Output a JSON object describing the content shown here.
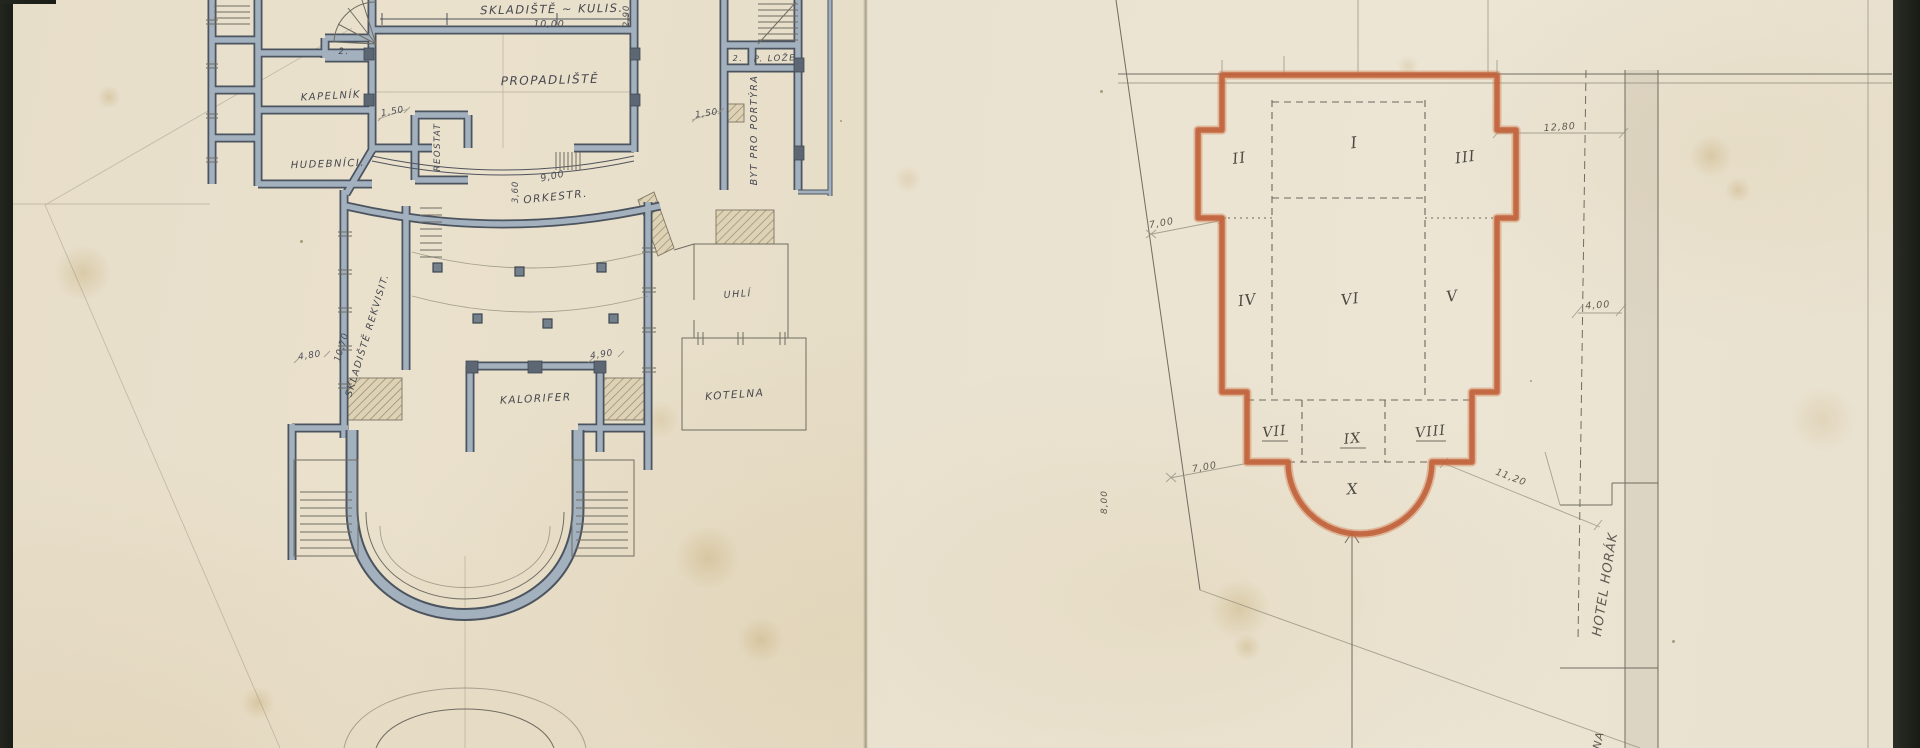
{
  "colors": {
    "paper_left": "#e8dfca",
    "paper_right": "#eae2d0",
    "mat_border": "#20231e",
    "wall_fill": "#a3b0bd",
    "wall_edge": "#4b545f",
    "site_outline_orange": "#c2613a",
    "ink": "#45484f",
    "pencil": "#5e5a50"
  },
  "left_plan": {
    "rooms": {
      "skladiste_kulis": "SKLADIŠTĚ ~ KULIS.",
      "propadliste": "PROPADLIŠTĚ",
      "kapelnik": "KAPELNÍK",
      "hudebnici": "HUDEBNÍCI.",
      "reostat": "REOSTAT",
      "orkestr": "ORKESTR.",
      "skladiste_rekvisit": "SKLADIŠTĚ REKVISIT.",
      "kalorifer": "KALORIFER",
      "uhli": "UHLÍ",
      "kotelna": "KOTELNA",
      "byt_pro_portyra": "BYT PRO PORTÝRA",
      "p_loze": "P. LOŽE",
      "room_no_2": "2."
    },
    "dimensions": {
      "d10_00": "10,00",
      "d2_90": "2,90",
      "d1_50": "1,50",
      "d9_00": "9,00",
      "d3_60": "3,60",
      "d10_70": "10,70",
      "d4_80": "4,80",
      "d4_90": "4,90"
    }
  },
  "site_plan": {
    "zones": {
      "z1": "I",
      "z2": "II",
      "z3": "III",
      "z4": "IV",
      "z5": "V",
      "z6": "VI",
      "z7": "VII",
      "z8": "VIII",
      "z9": "IX",
      "z10": "X"
    },
    "dimensions": {
      "d7_00": "7,00",
      "d12_80": "12,80",
      "d4_00": "4,00",
      "d11_20": "11,20",
      "d8_00": "8,00"
    },
    "labels": {
      "hotel_horak": "HOTEL HORÁK",
      "edge_text": "NA"
    }
  }
}
